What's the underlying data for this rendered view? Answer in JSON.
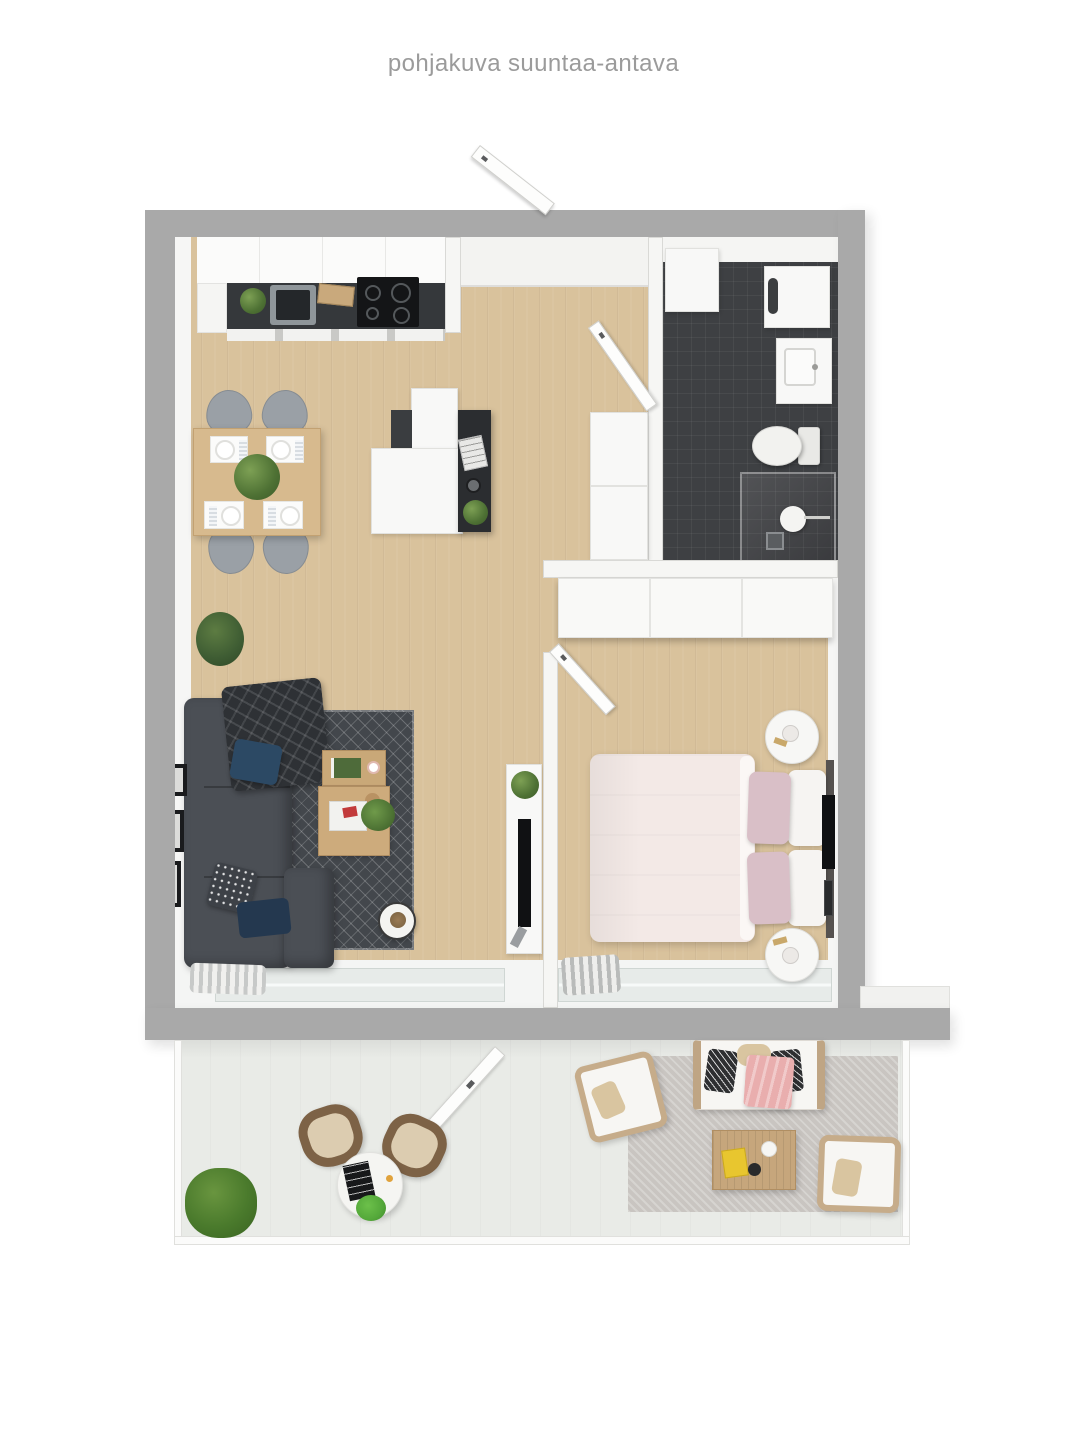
{
  "page": {
    "title": "pohjakuva suuntaa-antava"
  },
  "palette": {
    "background": "#ffffff",
    "wall": "#a9a9a9",
    "inner_wall": "#f6f6f4",
    "wood_floor": "#d9c29c",
    "balcony_floor": "#e9ebe7",
    "bathroom_floor": "#3e4043",
    "counter_dark": "#35383b",
    "sofa": "#4b4f55",
    "rug_dark": "#43474c",
    "bed": "#f3e9e6",
    "pillow_pink": "#d9bfc7",
    "wood_furniture": "#c9a878",
    "plant_green": "#5f8043",
    "outdoor_rug": "#c9c5c1",
    "blanket_pink": "#e9aeae"
  }
}
